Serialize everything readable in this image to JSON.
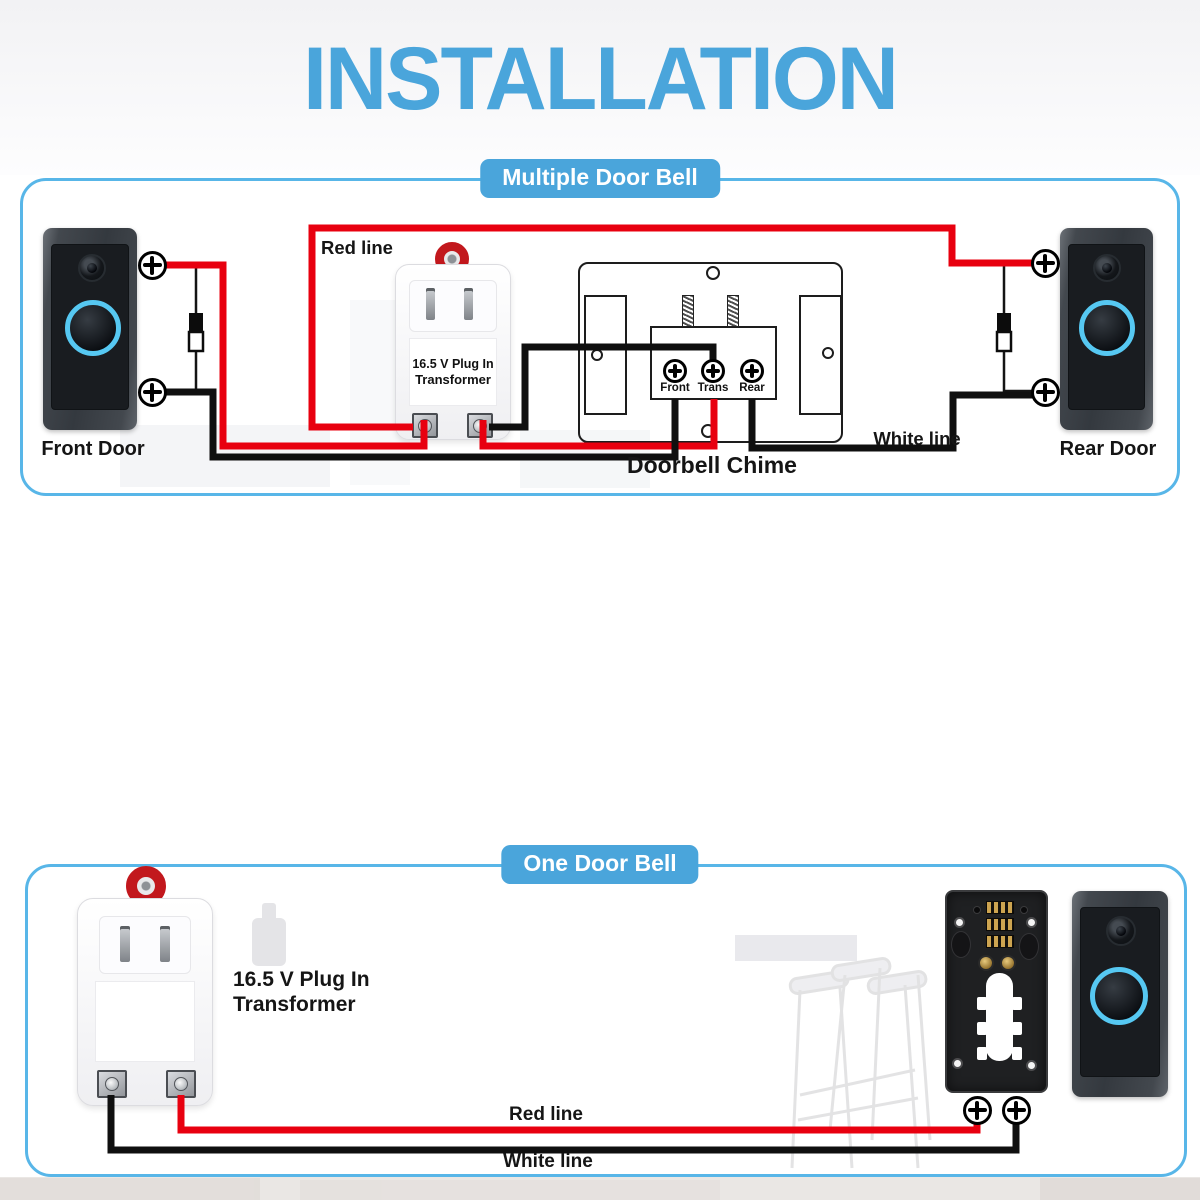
{
  "title": "INSTALLATION",
  "colors": {
    "accent_blue": "#4AA5DB",
    "border_blue": "#58B6E8",
    "wire_red": "#E8000F",
    "wire_black": "#0F0F0F",
    "ring_cyan": "#56C8F2",
    "ring_red": "#C2181D"
  },
  "section_multiple": {
    "badge": "Multiple Door Bell",
    "red_line_label": "Red line",
    "white_line_label": "White line",
    "front_door_label": "Front Door",
    "rear_door_label": "Rear Door",
    "transformer": {
      "line1": "16.5 V Plug In",
      "line2": "Transformer"
    },
    "chime": {
      "label": "Doorbell Chime",
      "terminals": [
        "Front",
        "Trans",
        "Rear"
      ]
    }
  },
  "section_single": {
    "badge": "One Door Bell",
    "red_line_label": "Red line",
    "white_line_label": "White line",
    "transformer": {
      "line1": "16.5 V Plug In",
      "line2": "Transformer"
    }
  }
}
